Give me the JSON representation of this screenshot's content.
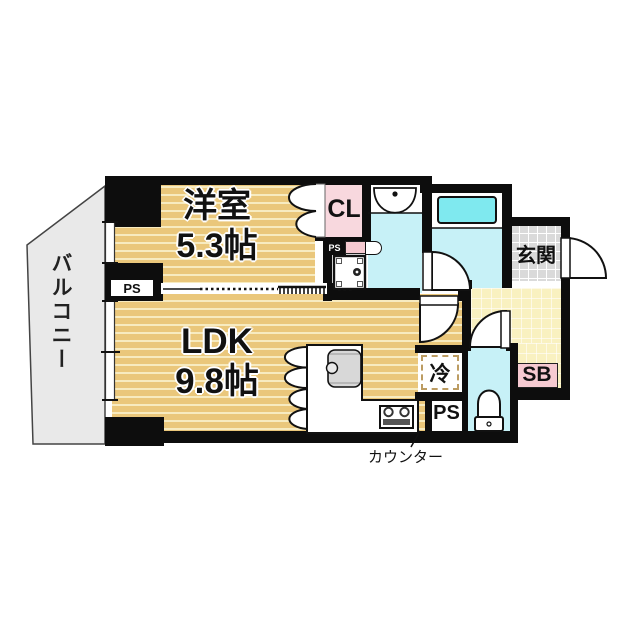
{
  "rooms": {
    "balcony": "バルコニー",
    "western_name": "洋室",
    "western_area": "5.3帖",
    "ldk_name": "LDK",
    "ldk_area": "9.8帖",
    "entrance": "玄関"
  },
  "features": {
    "closet": "CL",
    "shoe_box": "SB",
    "fridge": "冷",
    "ps_wall": "PS",
    "ps_kitchen": "PS",
    "ps_small": "PS",
    "counter": "カウンター"
  },
  "colors": {
    "wall": "#0d0d0d",
    "tatami_base": "#eac77b",
    "tatami_stripe": "#f7ebc0",
    "water_room": "#c7f1f7",
    "bathtub": "#7fe9ef",
    "closet_pink": "#f8d8de",
    "shoebox_pink": "#f6cad1",
    "entrance_tile": "#dadada",
    "hallway": "#f9f1c0",
    "balcony": "#e9e9e9"
  }
}
